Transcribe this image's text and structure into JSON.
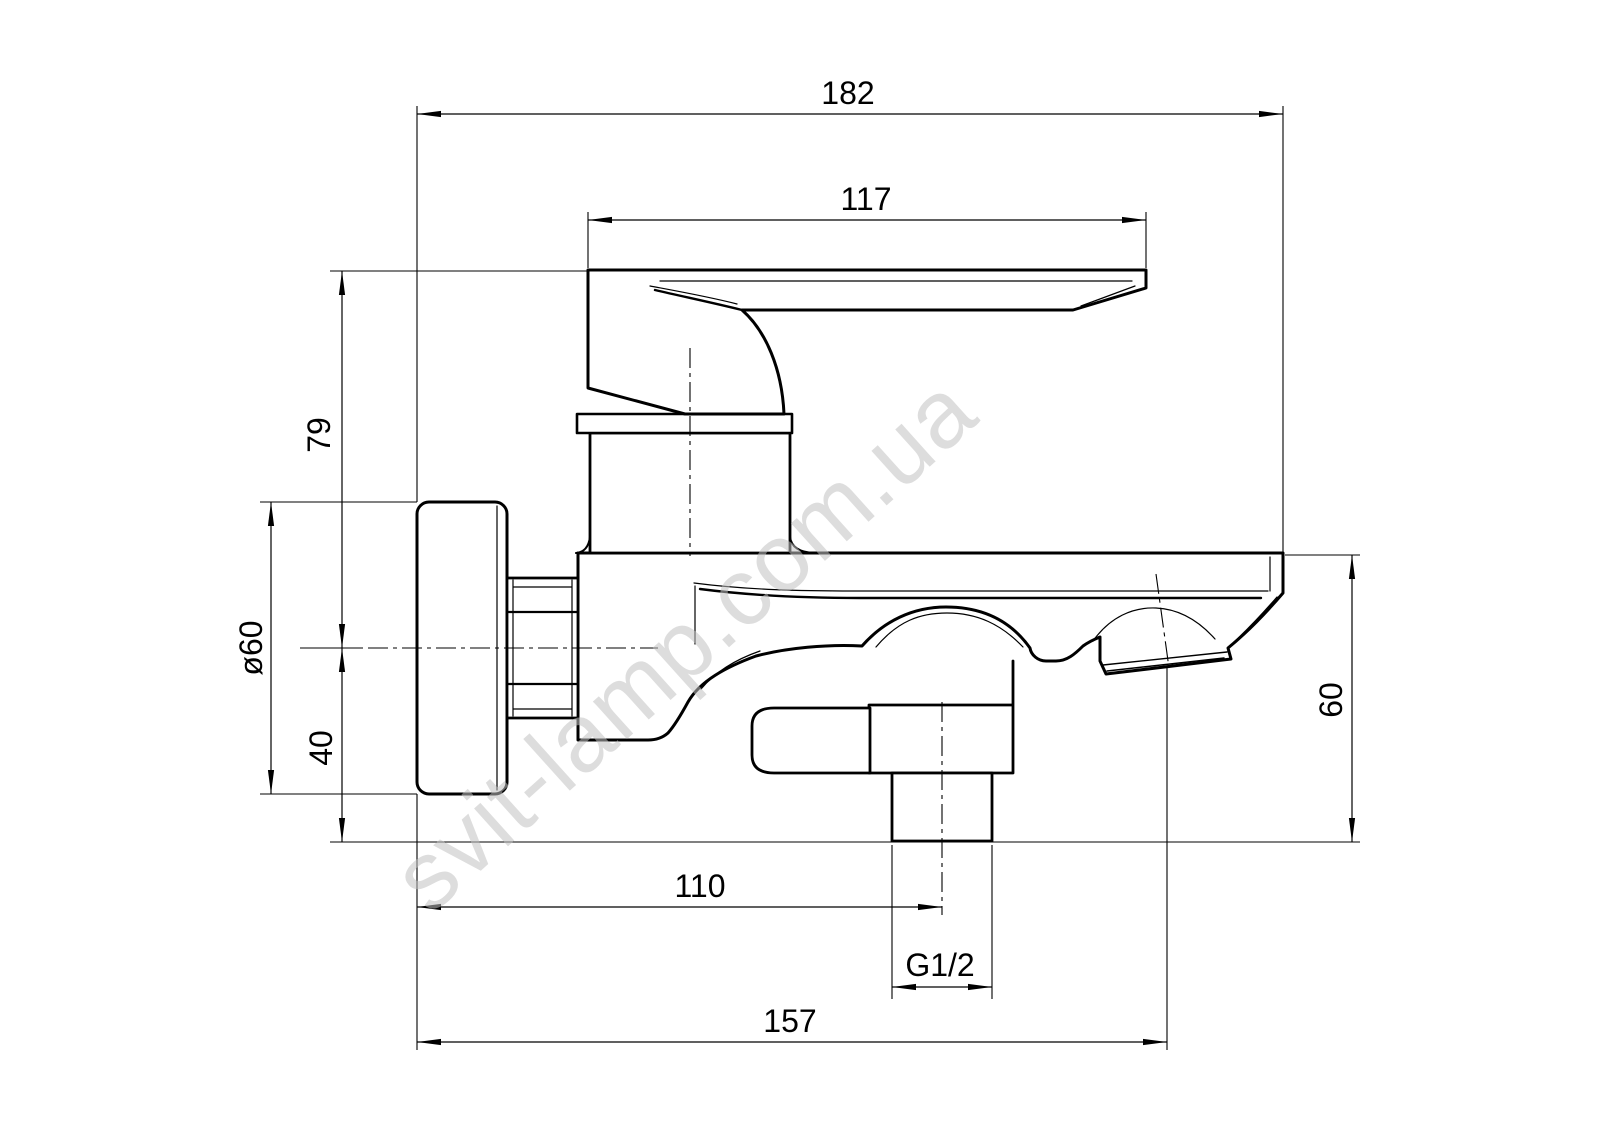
{
  "drawing": {
    "watermark": "svit-lamp.com.ua",
    "labels": {
      "overall_width": "182",
      "lever_length": "117",
      "axis_to_top": "79",
      "escutcheon_diameter": "ø60",
      "axis_to_body_bottom": "40",
      "spout_top_to_bottom": "60",
      "wall_to_shower_axis": "110",
      "thread_size": "G1/2",
      "wall_to_spout_outlet": "157"
    },
    "colors": {
      "line": "#000000",
      "background": "#ffffff",
      "watermark": "#c2c2c2"
    }
  }
}
